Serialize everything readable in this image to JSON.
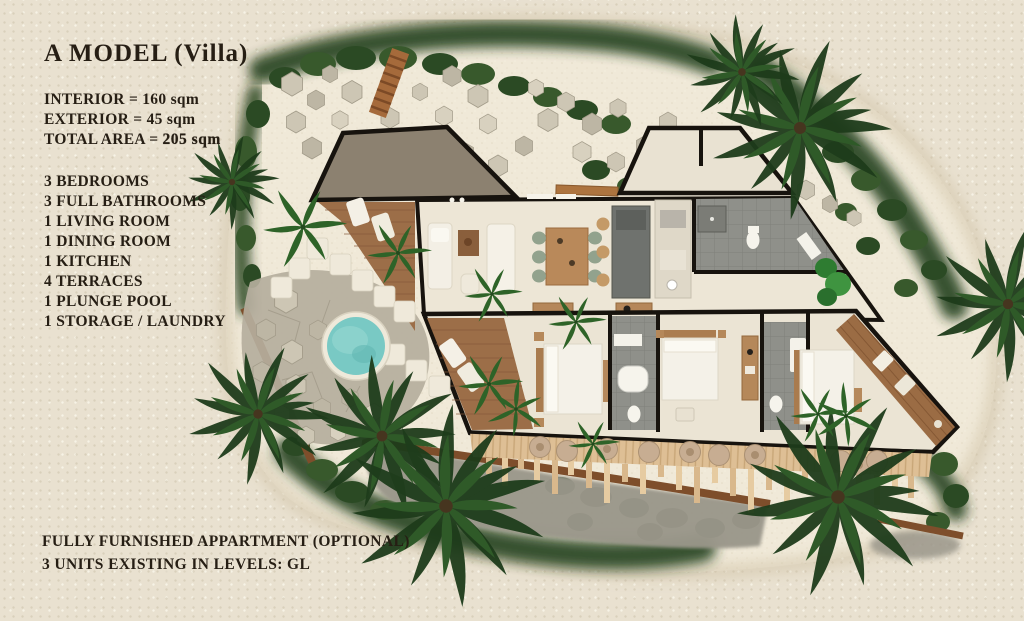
{
  "header": {
    "title_main": "A MODEL",
    "title_suffix": "(Villa)"
  },
  "specs": {
    "interior": "INTERIOR = 160 sqm",
    "exterior": "EXTERIOR = 45 sqm",
    "total_label": "TOTAL AREA = ",
    "total_value": "205 sqm"
  },
  "features": [
    "3 BEDROOMS",
    "3 FULL BATHROOMS",
    "1 LIVING ROOM",
    "1 DINING ROOM",
    "1 KITCHEN",
    "4 TERRACES",
    "1 PLUNGE POOL",
    "1 STORAGE / LAUNDRY"
  ],
  "footer": {
    "line1": "FULLY FURNISHED APPARTMENT (OPTIONAL)",
    "line2": "3 UNITS EXISTING IN LEVELS: GL"
  },
  "colors": {
    "ink": "#261e14",
    "paper": "#e9e1d0",
    "sand": "#f0e9d8",
    "pool_water": "#79c9c4",
    "vegetation": "#2b4a24",
    "wood_deck": "#9c6e48",
    "roof": "#8c8170",
    "wall": "#17130e",
    "stone": "#bdb6a4"
  }
}
